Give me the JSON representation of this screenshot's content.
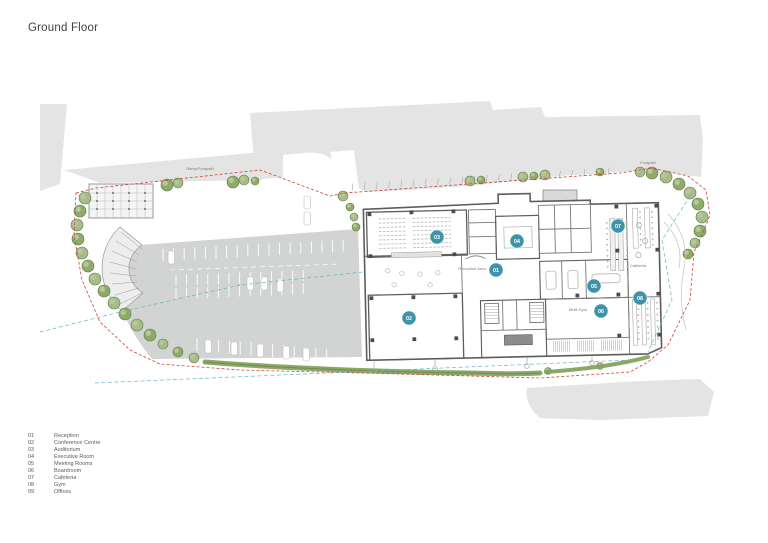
{
  "title": "Ground Floor",
  "legend": {
    "items": [
      {
        "num": "01",
        "label": "Reception"
      },
      {
        "num": "02",
        "label": "Conference Centre"
      },
      {
        "num": "03",
        "label": "Auditorium"
      },
      {
        "num": "04",
        "label": "Executive Room"
      },
      {
        "num": "05",
        "label": "Meeting Rooms"
      },
      {
        "num": "06",
        "label": "Boardroom"
      },
      {
        "num": "07",
        "label": "Cafeteria"
      },
      {
        "num": "08",
        "label": "Gym"
      },
      {
        "num": "09",
        "label": "Offices"
      }
    ]
  },
  "plan": {
    "marker_color": "#3f93a8",
    "markers": [
      {
        "num": "01",
        "x": 496,
        "y": 270
      },
      {
        "num": "02",
        "x": 409,
        "y": 318
      },
      {
        "num": "03",
        "x": 437,
        "y": 237
      },
      {
        "num": "04",
        "x": 517,
        "y": 241
      },
      {
        "num": "05",
        "x": 594,
        "y": 286
      },
      {
        "num": "06",
        "x": 601,
        "y": 311
      },
      {
        "num": "07",
        "x": 618,
        "y": 226
      },
      {
        "num": "08",
        "x": 640,
        "y": 298
      }
    ],
    "annotations": [
      {
        "text": "Ramp/Footpath",
        "x": 200,
        "y": 170
      },
      {
        "text": "Footpath",
        "x": 648,
        "y": 164
      },
      {
        "text": "Reception Area",
        "x": 472,
        "y": 270
      },
      {
        "text": "Cafeteria",
        "x": 638,
        "y": 267
      },
      {
        "text": "Multi Gym",
        "x": 578,
        "y": 311
      }
    ]
  }
}
